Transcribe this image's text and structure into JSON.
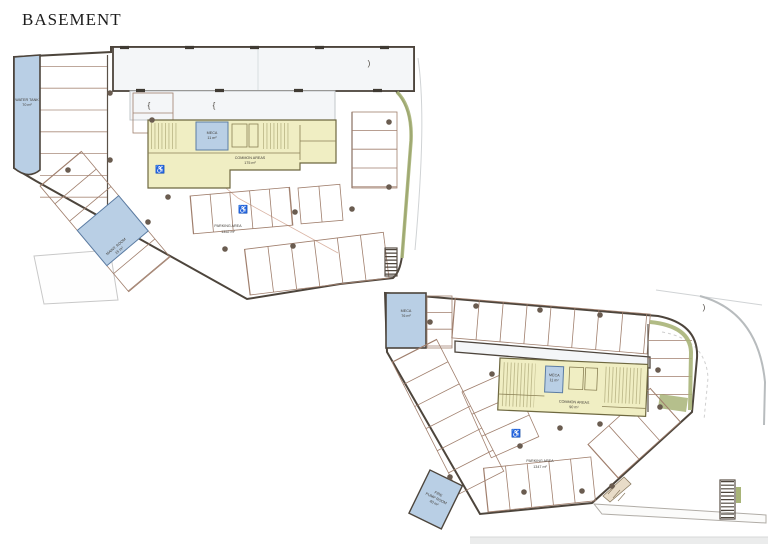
{
  "title": "BASEMENT",
  "colors": {
    "parking_fill": "#f1cabc",
    "core_fill": "#f0eec3",
    "wet_fill": "#b9cfe5",
    "green": "#a8b478",
    "ramp_fill": "#f4f6f8",
    "band_fill": "#ebecec"
  },
  "icons": {
    "accessible": "♿"
  },
  "marks": {
    "curly": "{",
    "paren": ")"
  },
  "plans": [
    {
      "labels": {
        "water_tank": [
          "WATER TANK",
          "70 m²"
        ],
        "meca": [
          "MECA",
          "11 m²"
        ],
        "common": [
          "COMMON AREAS",
          "175 m²"
        ],
        "maint": [
          "MAINT. ROOM",
          "15 m²"
        ],
        "parking": [
          "PARKING AREA",
          "1352 m²"
        ]
      }
    },
    {
      "labels": {
        "meca_room": [
          "MECA",
          "76 m²"
        ],
        "meca": [
          "MECA",
          "11 m²"
        ],
        "common": [
          "COMMON AREAS",
          "90 m²"
        ],
        "pump": [
          "FIRE",
          "PUMP ROOM",
          "40 m²"
        ],
        "parking": [
          "PARKING AREA",
          "1347 m²"
        ]
      }
    }
  ]
}
